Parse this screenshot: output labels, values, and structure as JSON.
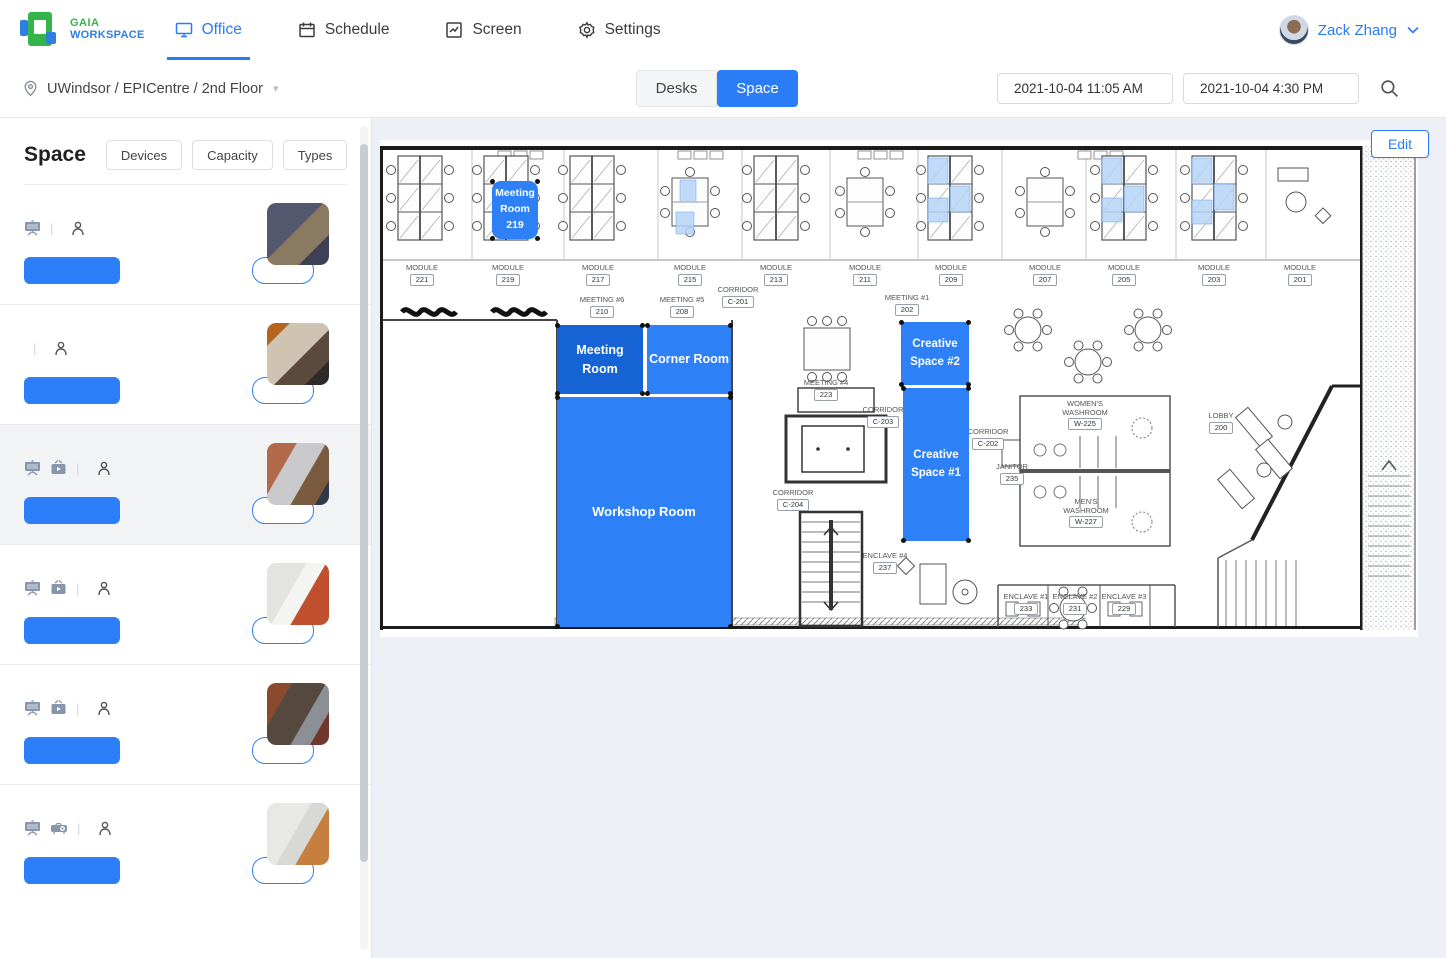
{
  "header": {
    "brand": {
      "line1": "GAIA",
      "line2": "WORKSPACE"
    },
    "tabs": [
      {
        "label": "Office",
        "active": true
      },
      {
        "label": "Schedule",
        "active": false
      },
      {
        "label": "Screen",
        "active": false
      },
      {
        "label": "Settings",
        "active": false
      }
    ],
    "user": {
      "name": "Zack Zhang"
    }
  },
  "toolbar": {
    "breadcrumb": "UWindsor / EPICentre / 2nd Floor",
    "toggle": {
      "desks": "Desks",
      "space": "Space",
      "selected": "Space"
    },
    "start_time": "2021-10-04 11:05 AM",
    "end_time": "2021-10-04 4:30 PM"
  },
  "sidebar": {
    "title": "Space",
    "filters": [
      "Devices",
      "Capacity",
      "Types"
    ],
    "time_slot": "09:00~16:30",
    "book_label": "Book",
    "rooms": [
      {
        "name": "Meeting Room 219",
        "devices": [
          "screen"
        ],
        "devices_text": "",
        "capacity": "2",
        "time": "09:00~16:30",
        "book": "Book",
        "selected": false
      },
      {
        "name": "Creative Space #2",
        "devices": [],
        "devices_text": "No devices",
        "capacity": "2",
        "time": "09:00~16:30",
        "book": "Book",
        "selected": false
      },
      {
        "name": "Meeting Room",
        "devices": [
          "screen",
          "tv"
        ],
        "devices_text": "",
        "capacity": "2",
        "time": "09:00~16:30",
        "book": "Book",
        "selected": true
      },
      {
        "name": "Corner Room",
        "devices": [
          "screen",
          "tv"
        ],
        "devices_text": "",
        "capacity": "2",
        "time": "09:00~16:30",
        "book": "Book",
        "selected": false
      },
      {
        "name": "Creative Space #1",
        "devices": [
          "screen",
          "tv"
        ],
        "devices_text": "",
        "capacity": "3",
        "time": "09:00~16:30",
        "book": "Book",
        "selected": false
      },
      {
        "name": "Workshop Room",
        "devices": [
          "screen",
          "projector"
        ],
        "devices_text": "",
        "capacity": "8",
        "time": "09:00~16:30",
        "book": "Book",
        "selected": false
      }
    ]
  },
  "floorplan": {
    "edit_label": "Edit",
    "accent_color": "#2e80f7",
    "selected_color": "#1563d5",
    "overlays": [
      {
        "id": "meeting-room-219",
        "lines": [
          "Meeting",
          "Room",
          "219"
        ],
        "x": 112,
        "y": 41,
        "w": 46,
        "h": 58,
        "color": "#2e80f7",
        "fs": 10.5,
        "r": 9
      },
      {
        "id": "meeting-room",
        "lines": [
          "Meeting Room"
        ],
        "x": 177,
        "y": 185,
        "w": 86,
        "h": 69,
        "color": "#1563d5",
        "fs": 12.5,
        "r": 4
      },
      {
        "id": "corner-room",
        "lines": [
          "Corner Room"
        ],
        "x": 267,
        "y": 185,
        "w": 84,
        "h": 69,
        "color": "#2e80f7",
        "fs": 12.5,
        "r": 4
      },
      {
        "id": "workshop-room",
        "lines": [
          "Workshop Room"
        ],
        "x": 177,
        "y": 257,
        "w": 174,
        "h": 230,
        "color": "#2e80f7",
        "fs": 13,
        "r": 2
      },
      {
        "id": "creative-space-2",
        "lines": [
          "Creative",
          "Space #2"
        ],
        "x": 521,
        "y": 182,
        "w": 68,
        "h": 63,
        "color": "#2e80f7",
        "fs": 11.5,
        "r": 4
      },
      {
        "id": "creative-space-1",
        "lines": [
          "Creative",
          "Space #1"
        ],
        "x": 523,
        "y": 248,
        "w": 66,
        "h": 153,
        "color": "#2e80f7",
        "fs": 11.5,
        "r": 2
      }
    ],
    "labels": [
      {
        "l1": "MODULE",
        "l2": "221",
        "x": 42,
        "y": 124
      },
      {
        "l1": "MODULE",
        "l2": "219",
        "x": 128,
        "y": 124
      },
      {
        "l1": "MODULE",
        "l2": "217",
        "x": 218,
        "y": 124
      },
      {
        "l1": "MODULE",
        "l2": "215",
        "x": 310,
        "y": 124
      },
      {
        "l1": "MODULE",
        "l2": "213",
        "x": 396,
        "y": 124
      },
      {
        "l1": "MODULE",
        "l2": "211",
        "x": 485,
        "y": 124
      },
      {
        "l1": "MODULE",
        "l2": "209",
        "x": 571,
        "y": 124
      },
      {
        "l1": "MODULE",
        "l2": "207",
        "x": 665,
        "y": 124
      },
      {
        "l1": "MODULE",
        "l2": "205",
        "x": 744,
        "y": 124
      },
      {
        "l1": "MODULE",
        "l2": "203",
        "x": 834,
        "y": 124
      },
      {
        "l1": "MODULE",
        "l2": "201",
        "x": 920,
        "y": 124
      },
      {
        "l1": "MEETING #6",
        "l2": "210",
        "x": 222,
        "y": 156
      },
      {
        "l1": "MEETING #5",
        "l2": "208",
        "x": 302,
        "y": 156
      },
      {
        "l1": "CORRIDOR",
        "l2": "C-201",
        "x": 358,
        "y": 146
      },
      {
        "l1": "MEETING #1",
        "l2": "202",
        "x": 527,
        "y": 154
      },
      {
        "l1": "MEETING #4",
        "l2": "223",
        "x": 446,
        "y": 239
      },
      {
        "l1": "CORRIDOR",
        "l2": "C-203",
        "x": 503,
        "y": 266
      },
      {
        "l1": "CORRIDOR",
        "l2": "C-202",
        "x": 608,
        "y": 288
      },
      {
        "l1": "CORRIDOR",
        "l2": "C-204",
        "x": 413,
        "y": 349
      },
      {
        "l1": "WOMEN'S WASHROOM",
        "l2": "W-225",
        "x": 705,
        "y": 260
      },
      {
        "l1": "JANITOR",
        "l2": "235",
        "x": 632,
        "y": 323
      },
      {
        "l1": "MEN'S WASHROOM",
        "l2": "W-227",
        "x": 706,
        "y": 358
      },
      {
        "l1": "LOBBY",
        "l2": "200",
        "x": 841,
        "y": 272
      },
      {
        "l1": "ENCLAVE #1",
        "l2": "233",
        "x": 646,
        "y": 453
      },
      {
        "l1": "ENCLAVE #2",
        "l2": "231",
        "x": 695,
        "y": 453
      },
      {
        "l1": "ENCLAVE #3",
        "l2": "229",
        "x": 744,
        "y": 453
      },
      {
        "l1": "ENCLAVE #4",
        "l2": "237",
        "x": 505,
        "y": 412
      }
    ]
  }
}
